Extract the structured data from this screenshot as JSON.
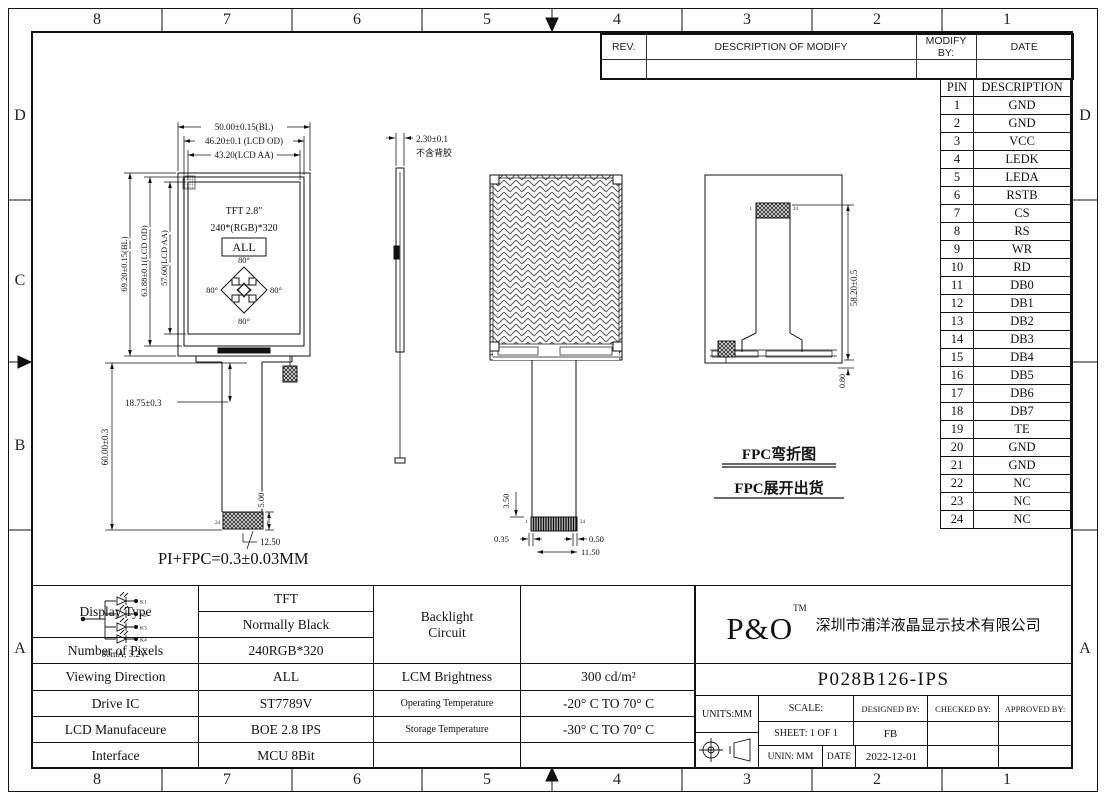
{
  "frame": {
    "top_labels": [
      "8",
      "7",
      "6",
      "5",
      "4",
      "3",
      "2",
      "1"
    ],
    "bottom_labels": [
      "8",
      "7",
      "6",
      "5",
      "4",
      "3",
      "2",
      "1"
    ],
    "left_labels": [
      "D",
      "C",
      "B",
      "A"
    ],
    "right_labels": [
      "D",
      "A"
    ]
  },
  "revision_table": {
    "rev": "REV.",
    "description": "DESCRIPTION OF MODIFY",
    "modify_by": "MODIFY BY:",
    "date": "DATE"
  },
  "pin_table": {
    "pin_header": "PIN",
    "desc_header": "DESCRIPTION",
    "rows": [
      {
        "pin": "1",
        "desc": "GND"
      },
      {
        "pin": "2",
        "desc": "GND"
      },
      {
        "pin": "3",
        "desc": "VCC"
      },
      {
        "pin": "4",
        "desc": "LEDK"
      },
      {
        "pin": "5",
        "desc": "LEDA"
      },
      {
        "pin": "6",
        "desc": "RSTB"
      },
      {
        "pin": "7",
        "desc": "CS"
      },
      {
        "pin": "8",
        "desc": "RS"
      },
      {
        "pin": "9",
        "desc": "WR"
      },
      {
        "pin": "10",
        "desc": "RD"
      },
      {
        "pin": "11",
        "desc": "DB0"
      },
      {
        "pin": "12",
        "desc": "DB1"
      },
      {
        "pin": "13",
        "desc": "DB2"
      },
      {
        "pin": "14",
        "desc": "DB3"
      },
      {
        "pin": "15",
        "desc": "DB4"
      },
      {
        "pin": "16",
        "desc": "DB5"
      },
      {
        "pin": "17",
        "desc": "DB6"
      },
      {
        "pin": "18",
        "desc": "DB7"
      },
      {
        "pin": "19",
        "desc": "TE"
      },
      {
        "pin": "20",
        "desc": "GND"
      },
      {
        "pin": "21",
        "desc": "GND"
      },
      {
        "pin": "22",
        "desc": "NC"
      },
      {
        "pin": "23",
        "desc": "NC"
      },
      {
        "pin": "24",
        "desc": "NC"
      }
    ]
  },
  "front_view": {
    "dim_bl_w": "50.00±0.15(BL)",
    "dim_od_w": "46.20±0.1 (LCD OD)",
    "dim_aa_w": "43.20(LCD AA)",
    "dim_bl_h": "69.20±0.15(BL)",
    "dim_od_h": "63.88±0.1(LCD OD)",
    "dim_aa_h": "57.60(LCD AA)",
    "dim_tail_top": "18.75±0.3",
    "dim_tail_len": "60.00±0.3",
    "dim_conn_h": "5.00",
    "dim_conn_w": "12.50",
    "panel_line1": "TFT 2.8″",
    "panel_line2": "240*(RGB)*320",
    "panel_line3": "ALL",
    "angle": "80°",
    "pin_left": "24",
    "pin_right": "1",
    "note": "PI+FPC=0.3±0.03MM"
  },
  "side_view": {
    "dim_thickness": "2.30±0.1",
    "note": "不含背胶"
  },
  "back_view": {
    "dim_tail": "3.50",
    "dim_a": "0.35",
    "dim_b": "0.50",
    "dim_c": "11.50",
    "pin_first": "1",
    "pin_last": "24"
  },
  "fpc_view": {
    "dim_len": "58.20±0.5",
    "dim_off": "0.80",
    "pin_first": "1",
    "pin_last": "24",
    "label_fold": "FPC弯折图",
    "label_unfold": "FPC展开出货"
  },
  "spec_table": {
    "display_type_label": "Display Type",
    "display_type_value1": "TFT",
    "display_type_value2": "Normally Black",
    "pixels_label": "Number of Pixels",
    "pixels_value": "240RGB*320",
    "viewing_label": "Viewing Direction",
    "viewing_value": "ALL",
    "drive_label": "Drive IC",
    "drive_value": "ST7789V",
    "manufacturer_label": "LCD Manufaceure",
    "manufacturer_value": "BOE 2.8 IPS",
    "interface_label": "Interface",
    "interface_value": "MCU 8Bit"
  },
  "env_table": {
    "backlight_label_1": "Backlight",
    "backlight_label_2": "Circuit",
    "backlight_rating": "80mA, 3.2V",
    "led_labels": [
      "K1",
      "K2",
      "K3",
      "K4"
    ],
    "brightness_label": "LCM Brightness",
    "brightness_value": "300 cd/m²",
    "operating_label": "Operating Temperature",
    "operating_value": "-20° C TO 70° C",
    "storage_label": "Storage Temperature",
    "storage_value": "-30° C TO 70° C"
  },
  "title_block": {
    "logo": "P&O",
    "logo_tm": "TM",
    "company": "深圳市浦洋液晶显示技术有限公司",
    "part_number": "P028B126-IPS",
    "units": "UNITS:MM",
    "scale_label": "SCALE:",
    "designed_label": "DESIGNED BY:",
    "checked_label": "CHECKED BY:",
    "approved_label": "APPROVED BY:",
    "sheet": "SHEET: 1 OF 1",
    "designer": "FB",
    "unin": "UNIN: MM",
    "date_label": "DATE",
    "date_value": "2022-12-01"
  }
}
